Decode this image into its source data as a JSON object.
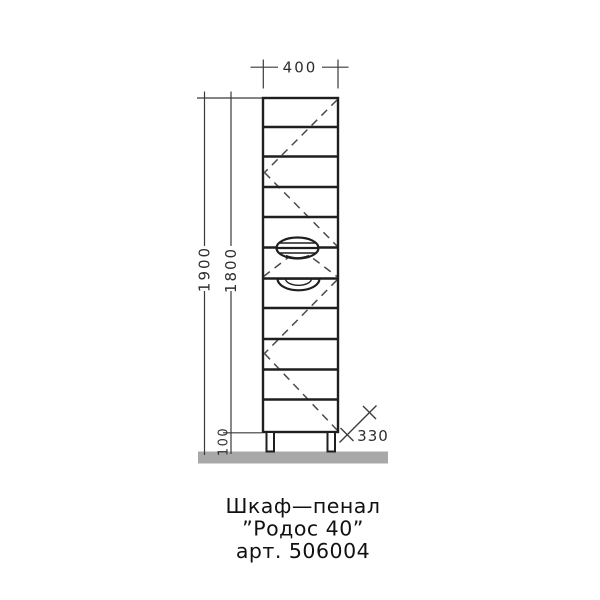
{
  "title_block": {
    "line1": "Шкаф—пенал",
    "line2": "”Родос  40”",
    "line3": "арт.  506004"
  },
  "dimensions": {
    "width": "400",
    "height_total": "1900",
    "height_body": "1800",
    "plinth_height": "100",
    "depth": "330"
  },
  "drawing": {
    "type": "furniture-front-view-technical-drawing",
    "sections_count": 11,
    "doors": [
      "upper-door-with-swing-dashes",
      "middle-drawer",
      "lower-door-with-swing-dashes"
    ],
    "handles": [
      "oval-recessed-handle",
      "half-oval-recessed-handle"
    ]
  },
  "colors": {
    "background": "#ffffff",
    "main_line": "#1f1f1f",
    "dimension_line": "#3a3a3a",
    "swing_dash_line": "#4a4a4a",
    "floor": "#a8a8a8"
  }
}
